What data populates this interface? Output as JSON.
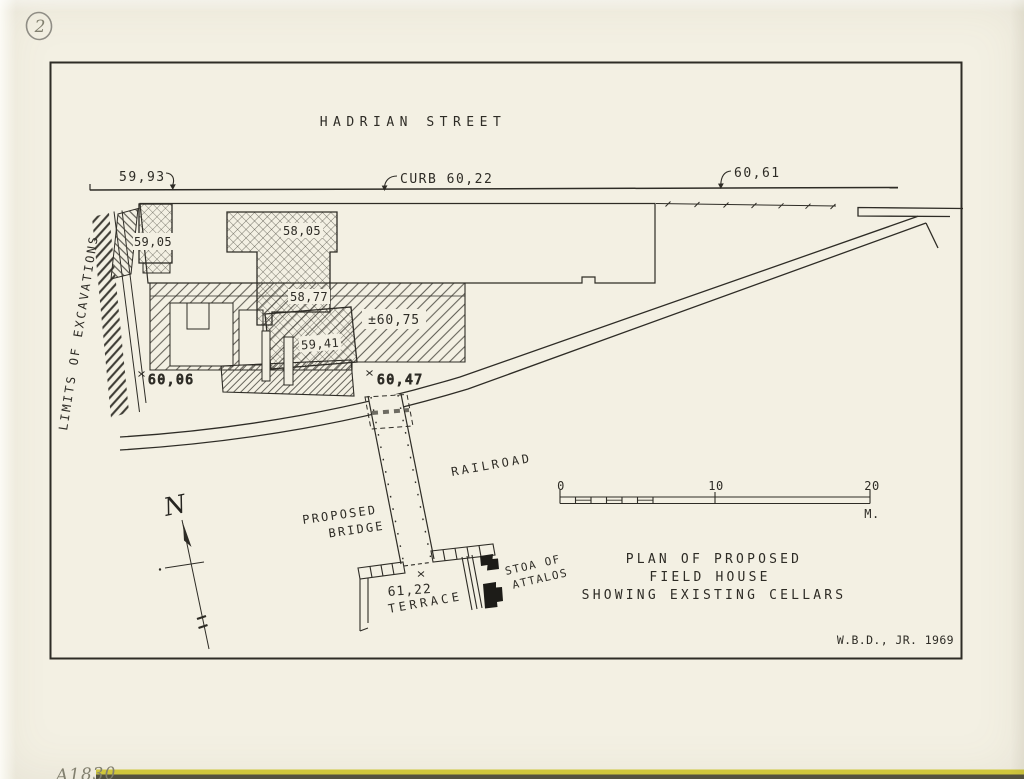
{
  "sheet": {
    "number": "2",
    "archive_code": "A1830",
    "signature": "W.B.D., JR. 1969"
  },
  "street": {
    "name": "HADRIAN STREET"
  },
  "curb": {
    "left_elevation": "59,93",
    "center_elevation": "CURB 60,22",
    "right_elevation": "60,61"
  },
  "excavation": {
    "limits_label": "LIMITS OF EXCAVATIONS",
    "cellars": {
      "c1": "59,05",
      "c2": "58,05",
      "c3": "58,77",
      "c4": "59,41"
    },
    "spots": {
      "s1": "±60,75",
      "s2": "60,06",
      "s3": "60,47"
    }
  },
  "railroad": {
    "label": "RAILROAD"
  },
  "bridge": {
    "line1": "PROPOSED",
    "line2": "BRIDGE"
  },
  "terrace": {
    "elevation": "61,22",
    "label": "TERRACE"
  },
  "stoa": {
    "line1": "STOA OF",
    "line2": "ATTALOS"
  },
  "compass": {
    "north": "N"
  },
  "scale_bar": {
    "zero": "0",
    "ten": "10",
    "twenty": "20",
    "unit": "M."
  },
  "title": {
    "line1": "PLAN OF PROPOSED",
    "line2": "FIELD HOUSE",
    "line3": "SHOWING EXISTING CELLARS"
  },
  "colors": {
    "ink": "#2e2c26",
    "paper": "#f3f0e3",
    "edge_strip_yellow": "#cfc63c",
    "edge_strip_dark": "#53513f"
  }
}
